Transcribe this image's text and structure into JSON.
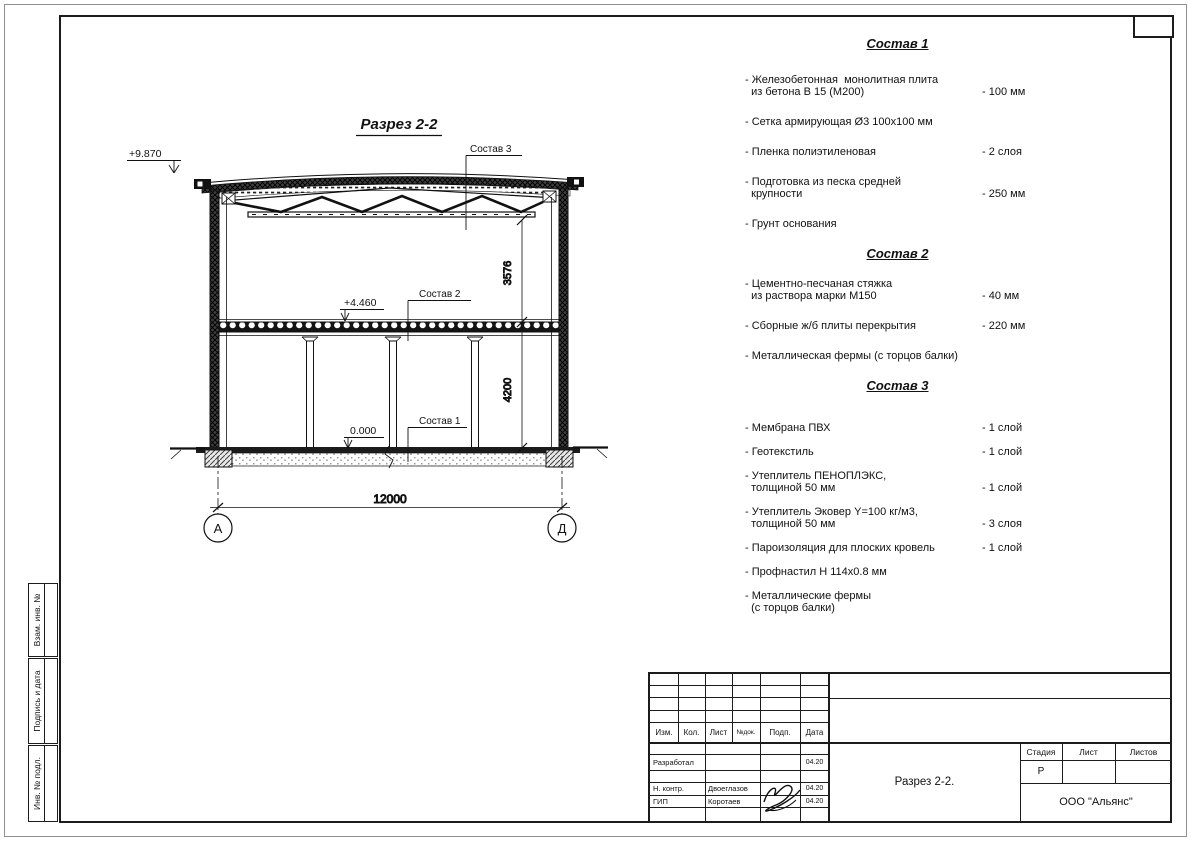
{
  "drawing": {
    "title": "Разрез 2-2",
    "elevations": {
      "roof": "+9.870",
      "floor2": "+4.460",
      "ground": "0.000"
    },
    "labels": {
      "sostav1": "Состав 1",
      "sostav2": "Состав 2",
      "sostav3": "Состав 3"
    },
    "dimensions": {
      "truss_height": "3576",
      "floor_height": "4200",
      "span": "12000"
    },
    "axes": {
      "left": "А",
      "right": "Д"
    }
  },
  "compositions": [
    {
      "title": "Состав 1",
      "items": [
        {
          "name": "- Железобетонная  монолитная плита\n  из бетона В 15 (М200)",
          "value": "- 100 мм"
        },
        {
          "name": "- Сетка армирующая Ø3 100х100 мм",
          "value": ""
        },
        {
          "name": "- Пленка полиэтиленовая",
          "value": "-  2 слоя"
        },
        {
          "name": "- Подготовка из песка средней\n  крупности",
          "value": "- 250 мм"
        },
        {
          "name": "- Грунт основания",
          "value": ""
        }
      ]
    },
    {
      "title": "Состав 2",
      "items": [
        {
          "name": "- Цементно-песчаная стяжка\n  из раствора марки М150",
          "value": "- 40 мм"
        },
        {
          "name": "- Сборные ж/б плиты перекрытия",
          "value": "- 220 мм"
        },
        {
          "name": "- Металлическая фермы (с торцов балки)",
          "value": ""
        }
      ]
    },
    {
      "title": "Состав 3",
      "items": [
        {
          "name": "- Мембрана ПВХ",
          "value": "- 1 слой"
        },
        {
          "name": "- Геотекстиль",
          "value": "- 1 слой"
        },
        {
          "name": "- Утеплитель ПЕНОПЛЭКС,\n  толщиной 50 мм",
          "value": "- 1 слой"
        },
        {
          "name": "- Утеплитель Эковер Y=100 кг/м3,\n  толщиной 50 мм",
          "value": "- 3 слоя"
        },
        {
          "name": "- Пароизоляция для плоских кровель",
          "value": "- 1 слой"
        },
        {
          "name": "- Профнастил Н 114х0.8 мм",
          "value": ""
        },
        {
          "name": "- Металлические фермы\n  (с торцов балки)",
          "value": ""
        }
      ]
    }
  ],
  "titleblock": {
    "header_cols": [
      "Изм.",
      "Кол.",
      "Лист",
      "№док.",
      "Подп.",
      "Дата"
    ],
    "rows": [
      {
        "role": "Разработал",
        "name": "",
        "date": "04.20"
      },
      {
        "role": "Н. контр.",
        "name": "Двоеглазов",
        "date": "04.20"
      },
      {
        "role": "ГИП",
        "name": "Коротаев",
        "date": "04.20"
      }
    ],
    "doc_title": "Разрез 2-2.",
    "company": "ООО \"Альянс\"",
    "stage_label": "Стадия",
    "sheet_label": "Лист",
    "sheets_label": "Листов",
    "stage_value": "Р"
  },
  "side_stamp": [
    "Взам. инв. №",
    "Подпись и дата",
    "Инв. № подл."
  ]
}
